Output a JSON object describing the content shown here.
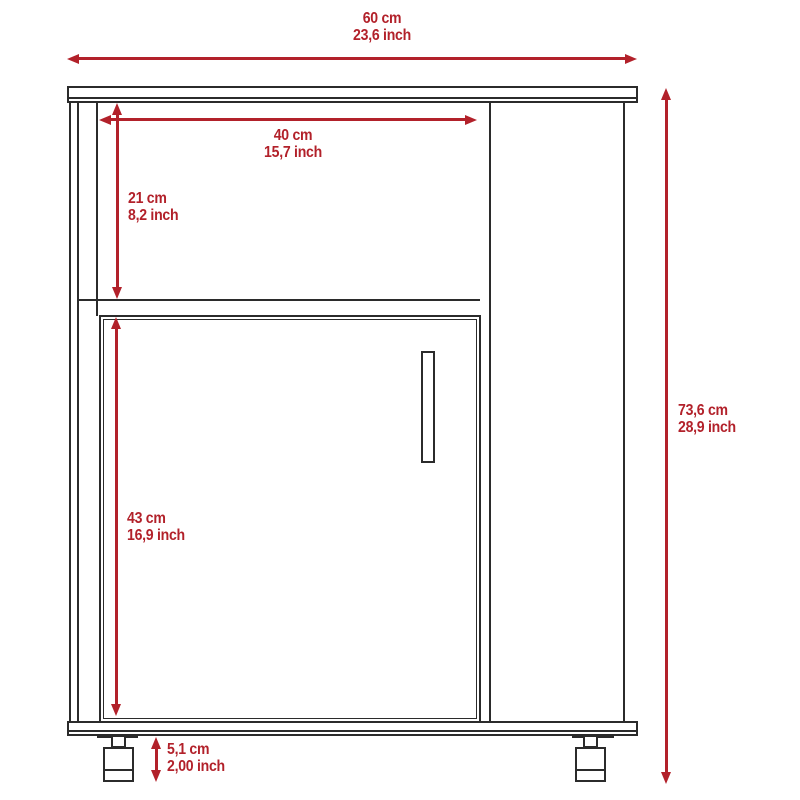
{
  "colors": {
    "dimension_red": "#b2212a",
    "line_dark": "#2b2b2b",
    "background": "#ffffff"
  },
  "drawing": {
    "type": "furniture-dimension-diagram",
    "subject": "cabinet front view with open shelf, single door and casters",
    "dimensions": {
      "overall_width": {
        "cm": "60 cm",
        "inch": "23,6 inch"
      },
      "opening_width": {
        "cm": "40 cm",
        "inch": "15,7 inch"
      },
      "opening_height": {
        "cm": "21 cm",
        "inch": "8,2 inch"
      },
      "door_height": {
        "cm": "43 cm",
        "inch": "16,9 inch"
      },
      "overall_height": {
        "cm": "73,6 cm",
        "inch": "28,9 inch"
      },
      "leg_height": {
        "cm": "5,1 cm",
        "inch": "2,00 inch"
      }
    }
  }
}
